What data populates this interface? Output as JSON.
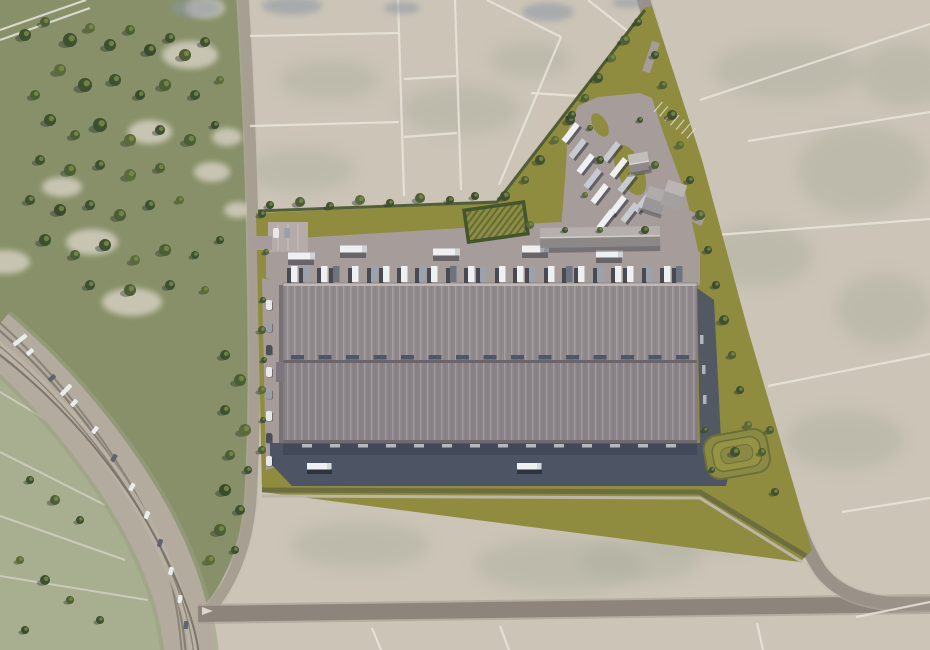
{
  "scene_type": "aerial-render-of-logistics-park-masterplan",
  "palette": {
    "field_beige": "#cbc4b7",
    "field_mottle": "#a9ac99",
    "scrub_green": "#879068",
    "sand": "#d8d2c4",
    "site_grass": "#8f8c3f",
    "hedge_dark": "#44552e",
    "pavement": "#a69c9a",
    "pavement_light": "#b5aca9",
    "apron_dark": "#4d5565",
    "apron_shadow": "#3c4453",
    "roof_north": "#918a8d",
    "roof_south": "#8a8488",
    "roof_seam": "#6b656b",
    "skylight": "#4e5767",
    "road_gray": "#a89f93",
    "road_dark": "#8d857c",
    "rail_band": "#b2ab9e",
    "rail_line": "#8a8478",
    "line_white": "#e9e5da",
    "truck_white": "#eef0f1",
    "trailer_gray": "#9aa3ad",
    "trailer_dark": "#6d747e",
    "tree_variants": [
      "#3d5030",
      "#4c5e35",
      "#5a6a3a",
      "#394b2c"
    ],
    "tree_highlight": "#82914a",
    "wet_blue": "#8d97a4"
  },
  "scene": {
    "trees": [
      [
        25,
        35,
        6,
        0
      ],
      [
        45,
        22,
        5,
        1
      ],
      [
        70,
        40,
        7,
        0
      ],
      [
        90,
        28,
        5,
        2
      ],
      [
        110,
        45,
        6,
        0
      ],
      [
        130,
        30,
        5,
        1
      ],
      [
        150,
        50,
        6,
        3
      ],
      [
        170,
        38,
        5,
        0
      ],
      [
        185,
        55,
        6,
        1
      ],
      [
        205,
        42,
        5,
        0
      ],
      [
        60,
        70,
        6,
        2
      ],
      [
        85,
        85,
        7,
        0
      ],
      [
        35,
        95,
        5,
        1
      ],
      [
        115,
        80,
        6,
        0
      ],
      [
        140,
        95,
        5,
        3
      ],
      [
        165,
        85,
        6,
        1
      ],
      [
        195,
        95,
        5,
        0
      ],
      [
        220,
        80,
        4,
        2
      ],
      [
        50,
        120,
        6,
        0
      ],
      [
        75,
        135,
        5,
        1
      ],
      [
        100,
        125,
        7,
        0
      ],
      [
        130,
        140,
        6,
        2
      ],
      [
        160,
        130,
        5,
        0
      ],
      [
        190,
        140,
        6,
        1
      ],
      [
        215,
        125,
        4,
        3
      ],
      [
        40,
        160,
        5,
        0
      ],
      [
        70,
        170,
        6,
        1
      ],
      [
        100,
        165,
        5,
        0
      ],
      [
        130,
        175,
        6,
        2
      ],
      [
        160,
        168,
        5,
        1
      ],
      [
        30,
        200,
        5,
        0
      ],
      [
        60,
        210,
        6,
        3
      ],
      [
        90,
        205,
        5,
        0
      ],
      [
        120,
        215,
        6,
        1
      ],
      [
        150,
        205,
        5,
        0
      ],
      [
        180,
        200,
        4,
        2
      ],
      [
        45,
        240,
        6,
        0
      ],
      [
        75,
        255,
        5,
        1
      ],
      [
        105,
        245,
        6,
        0
      ],
      [
        135,
        260,
        5,
        2
      ],
      [
        165,
        250,
        6,
        1
      ],
      [
        195,
        255,
        4,
        0
      ],
      [
        220,
        240,
        4,
        3
      ],
      [
        90,
        285,
        5,
        0
      ],
      [
        130,
        290,
        6,
        1
      ],
      [
        170,
        285,
        5,
        0
      ],
      [
        205,
        290,
        4,
        2
      ],
      [
        225,
        355,
        5,
        0
      ],
      [
        240,
        380,
        6,
        1
      ],
      [
        225,
        410,
        5,
        0
      ],
      [
        245,
        430,
        6,
        2
      ],
      [
        230,
        455,
        5,
        1
      ],
      [
        248,
        470,
        4,
        0
      ],
      [
        225,
        490,
        6,
        3
      ],
      [
        240,
        510,
        5,
        0
      ],
      [
        220,
        530,
        6,
        1
      ],
      [
        235,
        550,
        4,
        0
      ],
      [
        210,
        560,
        5,
        2
      ],
      [
        30,
        480,
        4,
        0
      ],
      [
        55,
        500,
        5,
        1
      ],
      [
        80,
        520,
        4,
        0
      ],
      [
        20,
        560,
        4,
        2
      ],
      [
        45,
        580,
        5,
        0
      ],
      [
        70,
        600,
        4,
        1
      ],
      [
        100,
        620,
        4,
        0
      ],
      [
        25,
        630,
        4,
        3
      ],
      [
        270,
        205,
        4,
        0
      ],
      [
        300,
        202,
        5,
        1
      ],
      [
        330,
        206,
        4,
        0
      ],
      [
        360,
        200,
        5,
        2
      ],
      [
        390,
        203,
        4,
        0
      ],
      [
        420,
        198,
        5,
        1
      ],
      [
        450,
        200,
        4,
        0
      ],
      [
        475,
        196,
        4,
        3
      ],
      [
        505,
        196,
        5,
        0
      ],
      [
        525,
        180,
        4,
        1
      ],
      [
        540,
        160,
        5,
        0
      ],
      [
        555,
        140,
        4,
        2
      ],
      [
        570,
        120,
        5,
        0
      ],
      [
        585,
        98,
        4,
        1
      ],
      [
        598,
        78,
        5,
        0
      ],
      [
        612,
        58,
        4,
        2
      ],
      [
        625,
        40,
        5,
        1
      ],
      [
        638,
        22,
        4,
        0
      ],
      [
        655,
        55,
        4,
        0
      ],
      [
        663,
        85,
        4,
        1
      ],
      [
        672,
        115,
        5,
        0
      ],
      [
        680,
        145,
        4,
        2
      ],
      [
        690,
        180,
        4,
        0
      ],
      [
        700,
        215,
        5,
        1
      ],
      [
        708,
        250,
        4,
        0
      ],
      [
        716,
        285,
        4,
        3
      ],
      [
        724,
        320,
        5,
        0
      ],
      [
        732,
        355,
        4,
        1
      ],
      [
        740,
        390,
        4,
        0
      ],
      [
        748,
        425,
        4,
        2
      ],
      [
        735,
        452,
        5,
        0
      ],
      [
        762,
        452,
        4,
        1
      ],
      [
        775,
        492,
        4,
        0
      ],
      [
        263,
        300,
        3,
        0
      ],
      [
        262,
        330,
        4,
        1
      ],
      [
        264,
        360,
        3,
        0
      ],
      [
        262,
        390,
        4,
        2
      ],
      [
        263,
        420,
        3,
        0
      ],
      [
        262,
        450,
        4,
        1
      ],
      [
        262,
        214,
        4,
        0
      ],
      [
        266,
        252,
        3,
        1
      ],
      [
        572,
        115,
        4,
        0
      ],
      [
        590,
        128,
        3,
        1
      ],
      [
        600,
        160,
        4,
        0
      ],
      [
        585,
        195,
        3,
        2
      ],
      [
        640,
        120,
        3,
        0
      ],
      [
        655,
        165,
        4,
        1
      ],
      [
        645,
        230,
        4,
        0
      ],
      [
        600,
        230,
        3,
        1
      ],
      [
        565,
        230,
        3,
        0
      ],
      [
        530,
        225,
        4,
        2
      ],
      [
        705,
        430,
        3,
        0
      ],
      [
        770,
        430,
        4,
        1
      ],
      [
        712,
        470,
        3,
        0
      ]
    ],
    "dock_trailers_north": [
      [
        291,
        0
      ],
      [
        303,
        1
      ],
      [
        321,
        0
      ],
      [
        333,
        2
      ],
      [
        352,
        0
      ],
      [
        371,
        1
      ],
      [
        383,
        0
      ],
      [
        401,
        0
      ],
      [
        419,
        1
      ],
      [
        431,
        0
      ],
      [
        450,
        2
      ],
      [
        468,
        0
      ],
      [
        480,
        1
      ],
      [
        499,
        0
      ],
      [
        517,
        0
      ],
      [
        529,
        1
      ],
      [
        548,
        0
      ],
      [
        566,
        2
      ],
      [
        578,
        0
      ],
      [
        597,
        1
      ],
      [
        615,
        0
      ],
      [
        627,
        0
      ],
      [
        646,
        1
      ],
      [
        664,
        0
      ],
      [
        676,
        2
      ]
    ],
    "south_dock_marks": {
      "count": 14,
      "start_x": 302,
      "step": 28,
      "y": 444
    },
    "skylights": {
      "count": 15,
      "start_x": 291,
      "step": 27.5,
      "y": 355
    },
    "yard_trailers": [
      [
        571,
        133,
        -52,
        0
      ],
      [
        578,
        149,
        -52,
        1
      ],
      [
        586,
        164,
        -52,
        0
      ],
      [
        593,
        179,
        -52,
        1
      ],
      [
        600,
        194,
        -52,
        0
      ],
      [
        612,
        152,
        -52,
        1
      ],
      [
        619,
        168,
        -52,
        0
      ],
      [
        627,
        183,
        -52,
        1
      ],
      [
        618,
        206,
        -52,
        0
      ],
      [
        630,
        213,
        -52,
        1
      ],
      [
        606,
        220,
        -52,
        0
      ],
      [
        643,
        203,
        -52,
        1
      ]
    ],
    "stall_lines": {
      "x": 654,
      "y": 112,
      "count": 7,
      "step": 5.5,
      "angle": -52,
      "len": 13
    },
    "court_trucks": [
      [
        352,
        249
      ],
      [
        445,
        252
      ],
      [
        534,
        249
      ],
      [
        608,
        254
      ],
      [
        300,
        256
      ]
    ],
    "apron_trucks": [
      [
        318,
        466
      ],
      [
        528,
        466
      ]
    ],
    "west_cars": [
      [
        269,
        300,
        0
      ],
      [
        269,
        322,
        1
      ],
      [
        269,
        345,
        2
      ],
      [
        269,
        367,
        0
      ],
      [
        269,
        389,
        1
      ],
      [
        269,
        411,
        0
      ],
      [
        269,
        433,
        2
      ],
      [
        269,
        456,
        0
      ]
    ],
    "parking_cars": [
      [
        276,
        228,
        0
      ],
      [
        287,
        228,
        1
      ]
    ],
    "highway_vehicles": [
      [
        30,
        352,
        -40,
        8,
        0
      ],
      [
        52,
        378,
        -44,
        8,
        1
      ],
      [
        74,
        403,
        -48,
        8,
        0
      ],
      [
        95,
        430,
        -53,
        8,
        0
      ],
      [
        114,
        458,
        -58,
        8,
        1
      ],
      [
        132,
        487,
        -63,
        8,
        0
      ],
      [
        147,
        515,
        -67,
        8,
        0
      ],
      [
        160,
        543,
        -72,
        8,
        1
      ],
      [
        171,
        571,
        -77,
        8,
        0
      ],
      [
        180,
        599,
        -81,
        8,
        0
      ],
      [
        186,
        625,
        -85,
        8,
        1
      ],
      [
        20,
        340,
        -38,
        16,
        0
      ],
      [
        66,
        390,
        -46,
        14,
        0
      ]
    ],
    "field_lines": [
      [
        0,
        30,
        86,
        0
      ],
      [
        0,
        40,
        90,
        8
      ],
      [
        398,
        0,
        404,
        196
      ],
      [
        455,
        0,
        461,
        190
      ],
      [
        250,
        36,
        398,
        33
      ],
      [
        250,
        126,
        399,
        122
      ],
      [
        404,
        79,
        456,
        76
      ],
      [
        404,
        137,
        457,
        133
      ],
      [
        487,
        0,
        561,
        37
      ],
      [
        561,
        37,
        499,
        185
      ],
      [
        588,
        0,
        654,
        52
      ],
      [
        531,
        93,
        579,
        96
      ],
      [
        700,
        100,
        930,
        24
      ],
      [
        748,
        141,
        930,
        112
      ],
      [
        703,
        236,
        930,
        219
      ],
      [
        768,
        386,
        930,
        354
      ],
      [
        842,
        512,
        930,
        498
      ],
      [
        372,
        628,
        381,
        650
      ],
      [
        500,
        626,
        509,
        650
      ],
      [
        757,
        623,
        763,
        650
      ],
      [
        856,
        617,
        930,
        602
      ]
    ],
    "patch_mottle": [
      [
        788,
        70,
        75,
        30
      ],
      [
        862,
        170,
        65,
        45
      ],
      [
        758,
        255,
        55,
        32
      ],
      [
        884,
        310,
        48,
        36
      ],
      [
        700,
        530,
        65,
        25
      ],
      [
        560,
        565,
        85,
        28
      ],
      [
        360,
        545,
        70,
        24
      ],
      [
        845,
        440,
        60,
        30
      ],
      [
        905,
        75,
        45,
        32
      ],
      [
        640,
        560,
        60,
        22
      ],
      [
        460,
        110,
        60,
        25
      ],
      [
        330,
        80,
        50,
        20
      ],
      [
        300,
        170,
        55,
        22
      ],
      [
        530,
        60,
        40,
        18
      ]
    ],
    "patch_sand": [
      [
        190,
        55,
        28,
        14
      ],
      [
        150,
        132,
        22,
        12
      ],
      [
        212,
        172,
        18,
        10
      ],
      [
        92,
        242,
        26,
        13
      ],
      [
        227,
        137,
        15,
        9
      ],
      [
        62,
        187,
        20,
        10
      ],
      [
        132,
        302,
        30,
        14
      ],
      [
        5,
        262,
        25,
        12
      ],
      [
        238,
        210,
        14,
        8
      ],
      [
        205,
        8,
        20,
        10
      ]
    ],
    "patch_wet": [
      [
        196,
        8,
        26,
        9
      ],
      [
        292,
        6,
        30,
        9
      ],
      [
        548,
        12,
        26,
        9
      ],
      [
        402,
        8,
        18,
        6
      ],
      [
        628,
        3,
        16,
        5
      ]
    ],
    "inner_field_lines": [
      [
        0,
        392,
        80,
        440
      ],
      [
        0,
        452,
        105,
        505
      ],
      [
        0,
        516,
        125,
        560
      ],
      [
        0,
        576,
        148,
        600
      ]
    ]
  }
}
